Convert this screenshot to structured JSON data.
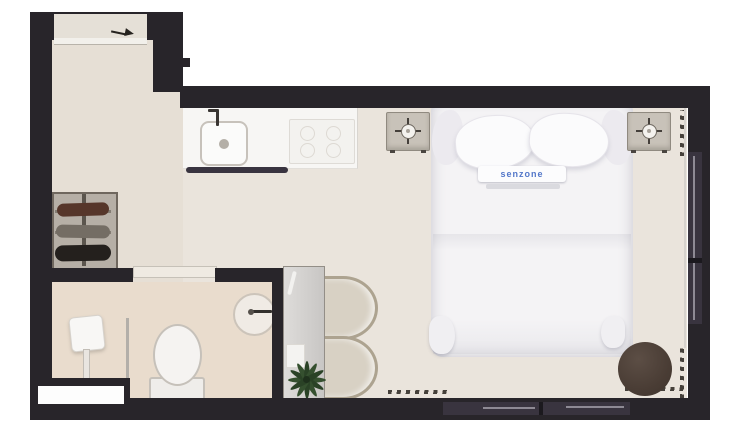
{
  "plan": {
    "type": "studio-apartment-floor-plan",
    "bed": {
      "brand_label": "senzone"
    },
    "colors": {
      "wall": "#28252a",
      "floor_main": "#eae4dc",
      "floor_hall": "#e6dfd5",
      "floor_bathroom": "#e9dccd",
      "bed_label_text": "#5377c9",
      "pouf": "#4a3d35",
      "plant": "#35502f",
      "chair": "#d8d1c4",
      "wardrobe": "#b6afa6",
      "window_frame": "#39343f"
    },
    "icons": [
      "table-lamp-icon",
      "sink-faucet-icon",
      "entry-arrow-icon",
      "shower-head-icon",
      "plant-icon",
      "drain-icon"
    ],
    "furniture": [
      "double-bed",
      "nightstand-left",
      "nightstand-right",
      "kitchen-counter",
      "kitchen-sink",
      "cooktop",
      "wardrobe",
      "desk",
      "chair-top",
      "chair-bottom",
      "plant",
      "pouf",
      "toilet",
      "shower",
      "washbasin"
    ]
  }
}
